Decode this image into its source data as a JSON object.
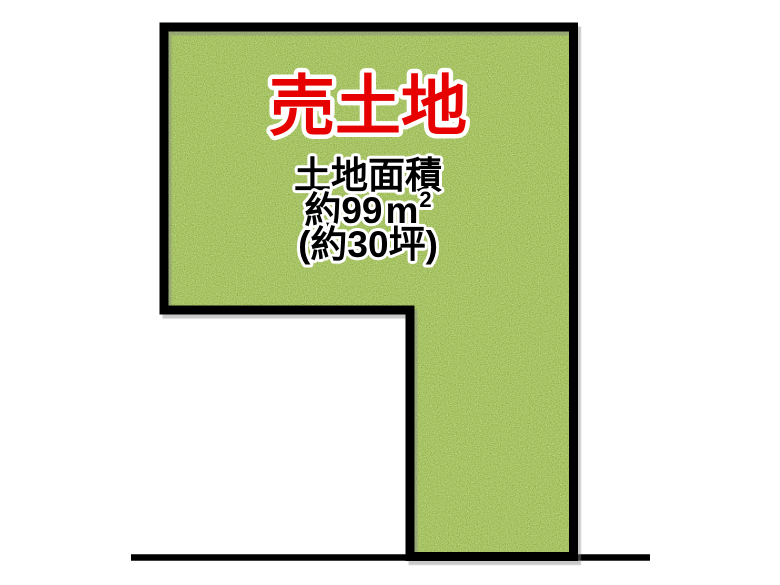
{
  "diagram": {
    "type": "real-estate-land-plan",
    "background_color": "#ffffff",
    "parcel": {
      "sale_label": "売土地",
      "sale_label_color": "#e60000",
      "area_title": "土地面積",
      "area_sqm": {
        "prefix": "約99",
        "unit": "m",
        "superscript": "2"
      },
      "area_tsubo": "(約30坪)",
      "area_text_color": "#000000",
      "text_outline_color": "#ffffff",
      "outline_color": "#000000",
      "fill_base_color": "#a7c365",
      "fill_texture_light": "#eeffc4",
      "fill_texture_dark": "#617d05"
    },
    "road_line": {
      "color": "#000000"
    }
  }
}
